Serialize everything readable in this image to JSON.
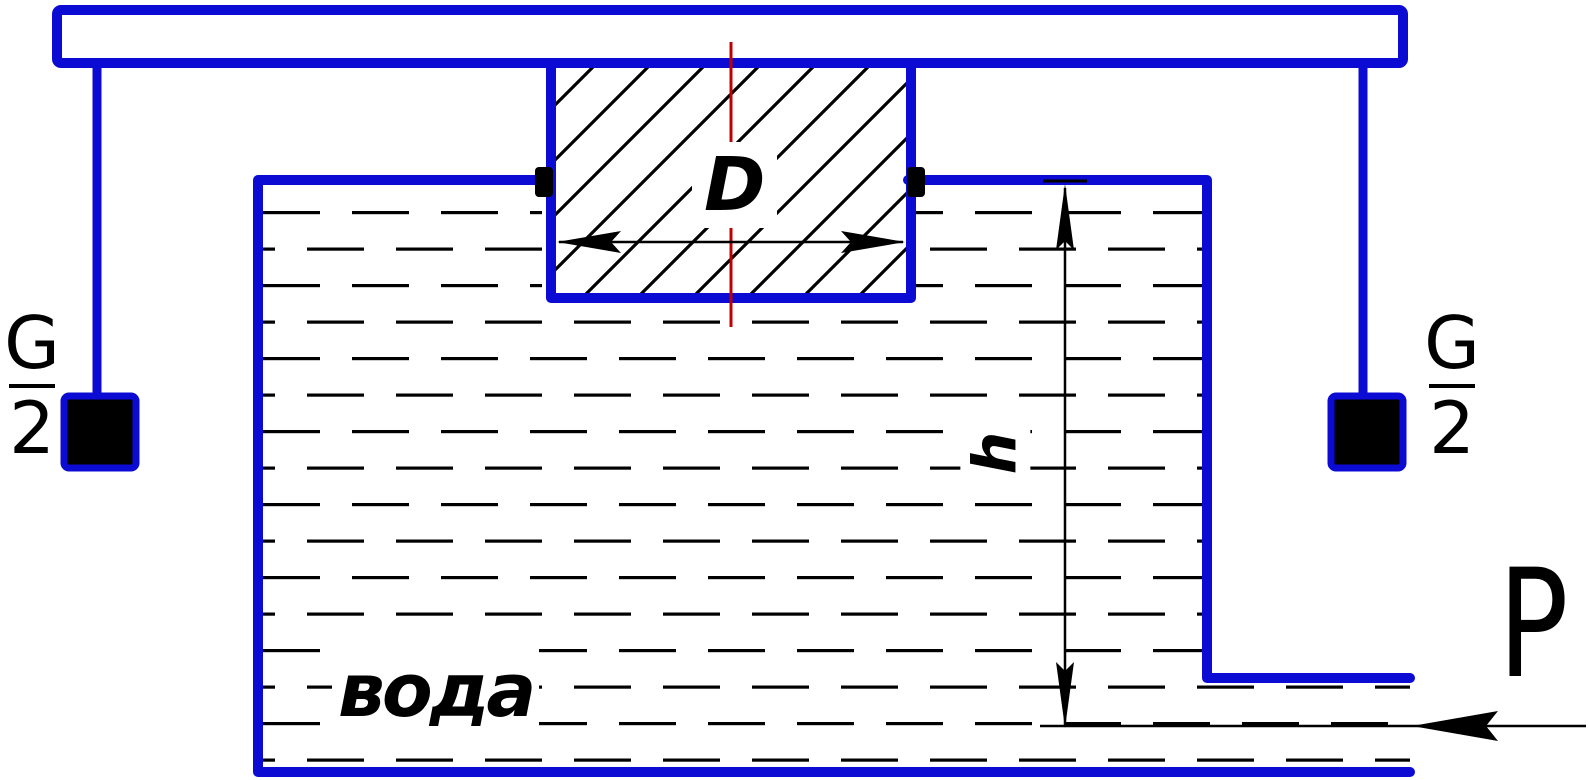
{
  "diagram": {
    "kind": "hydraulics-piston-tank-diagram",
    "labels": {
      "left_weight": {
        "numerator": "G",
        "denominator": "2"
      },
      "right_weight": {
        "numerator": "G",
        "denominator": "2"
      },
      "diameter": "D",
      "height": "h",
      "liquid": "вода",
      "pressure": "P"
    },
    "colors": {
      "structure": "#0b0bd4",
      "centerline": "#c00000",
      "ink": "#000000",
      "background": "#ffffff"
    }
  }
}
